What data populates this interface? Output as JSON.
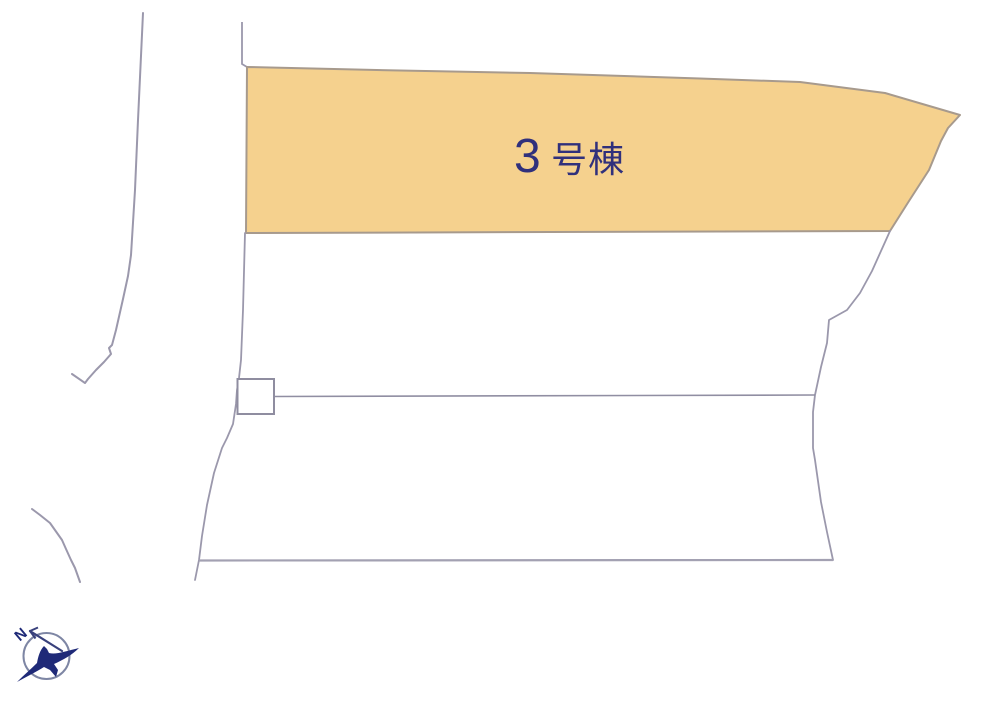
{
  "site_plan": {
    "lot_label": {
      "number": "3",
      "suffix": "号棟",
      "full": "3号棟",
      "color": "#30307c"
    },
    "highlight": {
      "fill": "#f5d18e",
      "stroke": "#a79a8d"
    },
    "outline_color": "#9b98ac",
    "compass": {
      "letter": "N",
      "color": "#1f2a78",
      "ring_color": "#7e86a4"
    }
  }
}
